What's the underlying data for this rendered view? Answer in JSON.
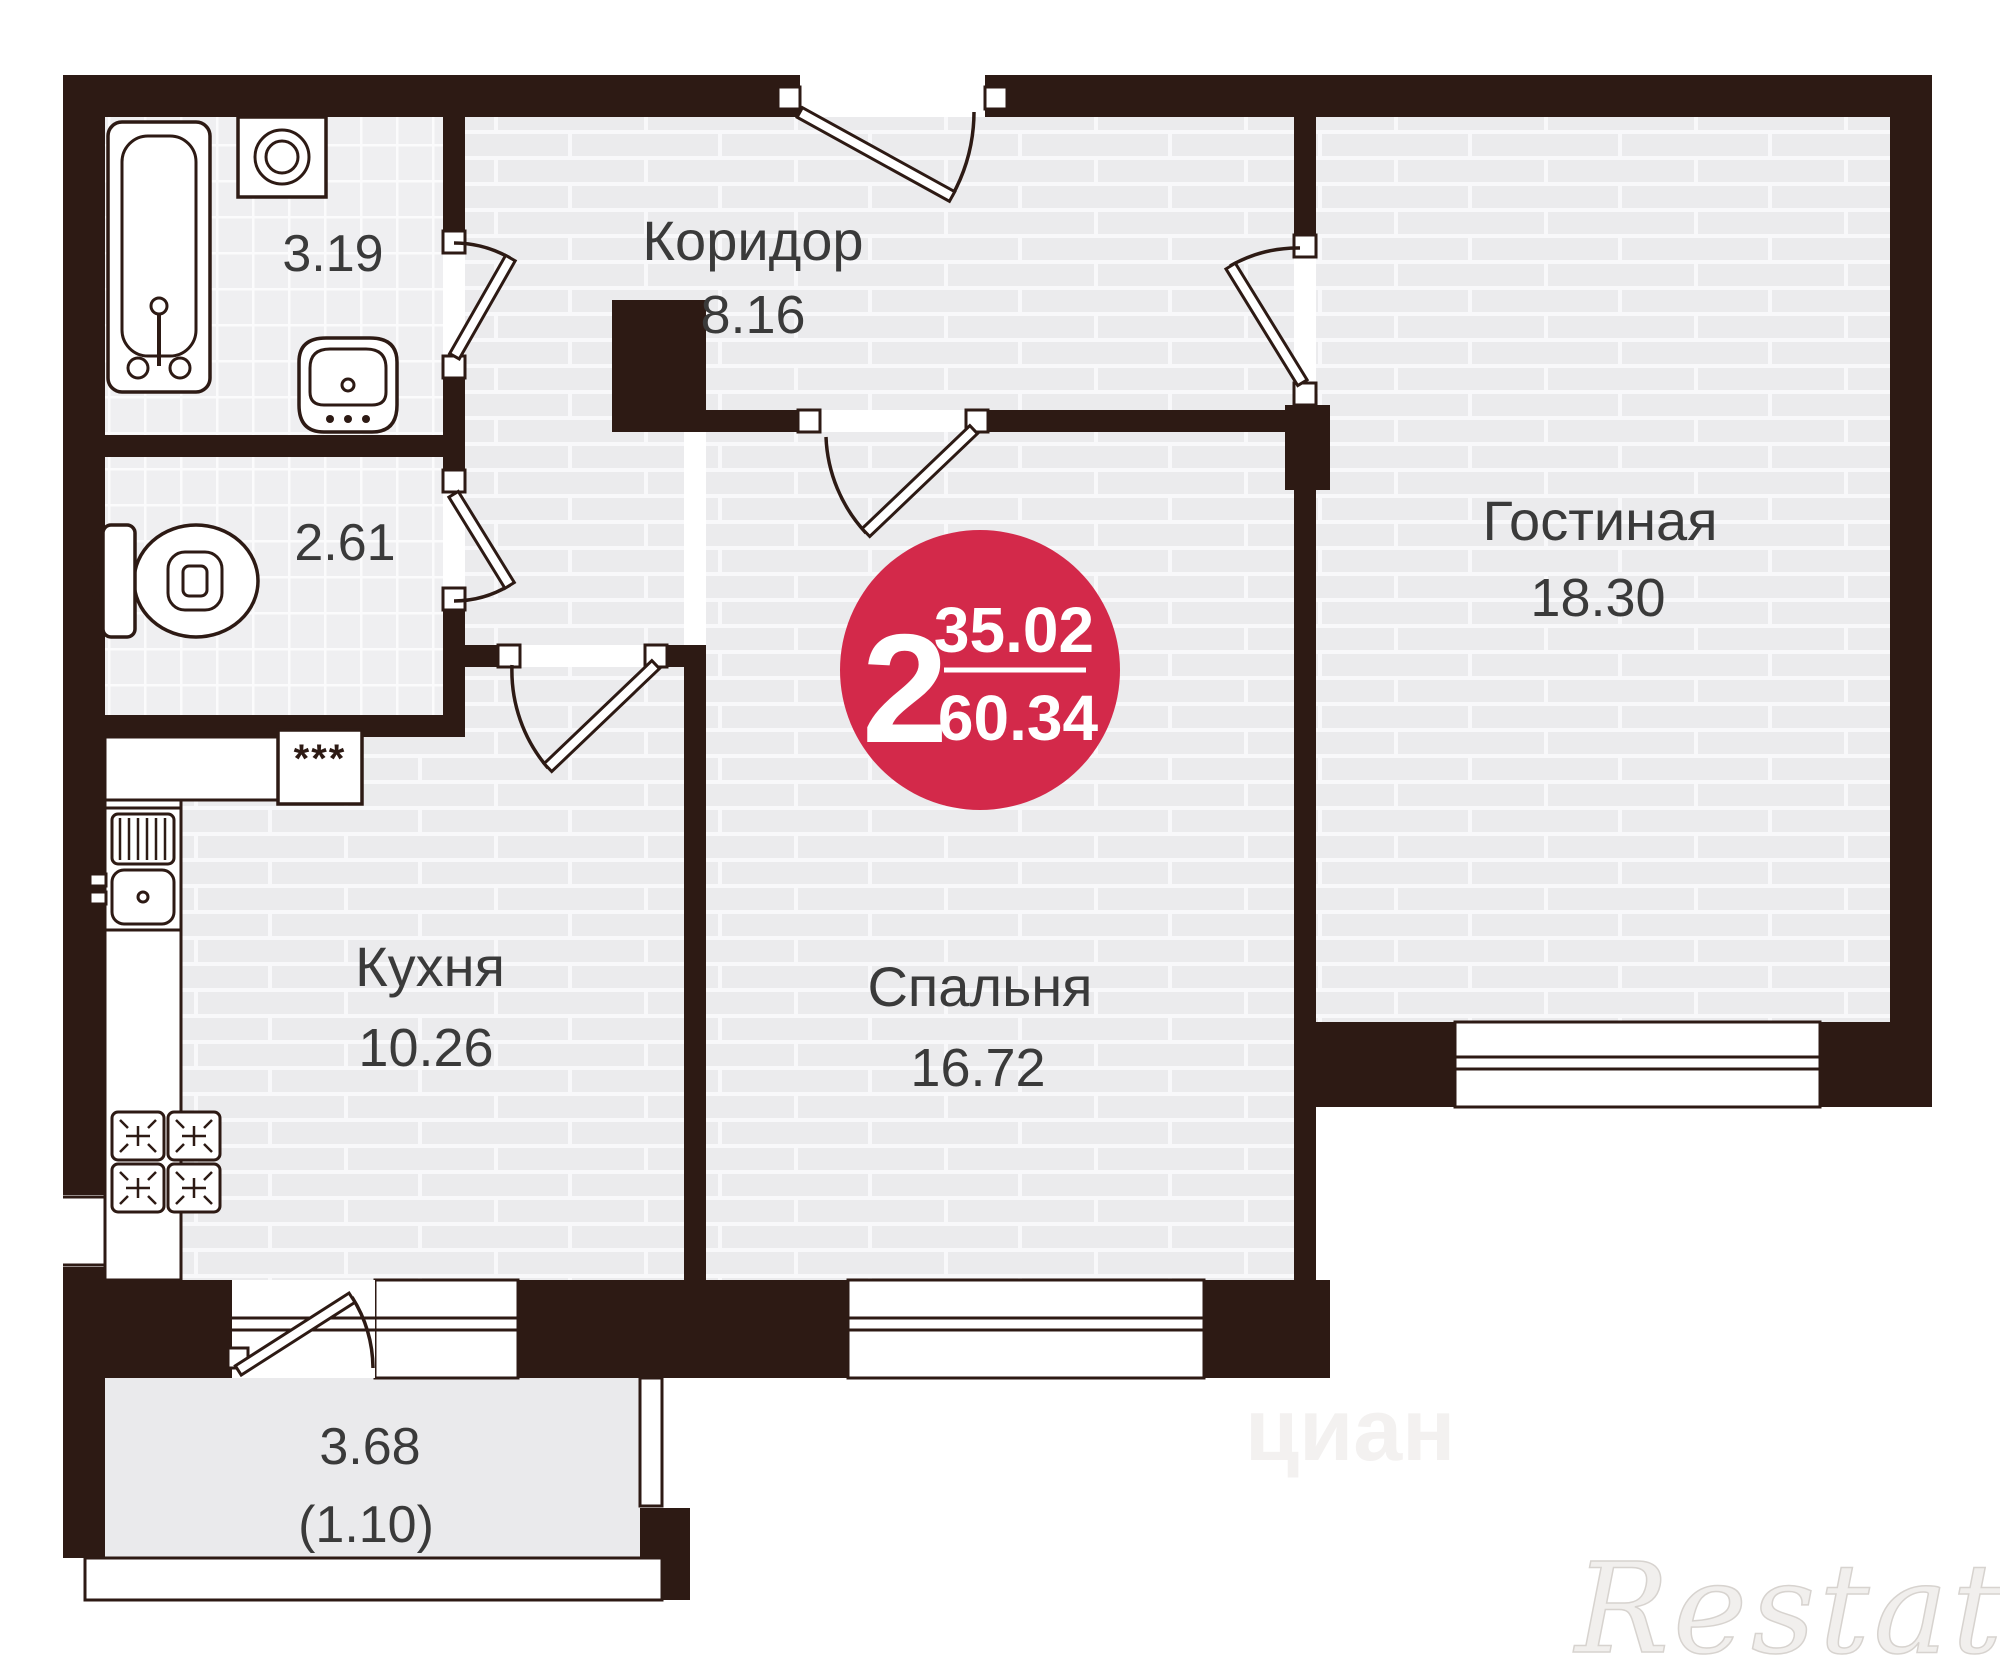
{
  "badge": {
    "room_count": "2",
    "living_area": "35.02",
    "total_area": "60.34",
    "bg_color": "#d3294a",
    "text_color": "#ffffff"
  },
  "rooms": {
    "corridor": {
      "label": "Коридор",
      "area": "8.16"
    },
    "living": {
      "label": "Гостиная",
      "area": "18.30"
    },
    "bedroom": {
      "label": "Спальня",
      "area": "16.72"
    },
    "kitchen": {
      "label": "Кухня",
      "area": "10.26"
    },
    "bathroom": {
      "area": "3.19"
    },
    "wc": {
      "area": "2.61"
    },
    "balcony": {
      "area": "3.68",
      "area_secondary": "(1.10)"
    }
  },
  "fixtures": {
    "oven_label": "***"
  },
  "watermarks": {
    "brand": "Restate",
    "portal": "циан"
  },
  "colors": {
    "wall": "#2d1a14",
    "floor": "#ebebed",
    "tile": "#efeff1",
    "balcony_floor": "#eaeaec",
    "accent": "#d3294a"
  }
}
